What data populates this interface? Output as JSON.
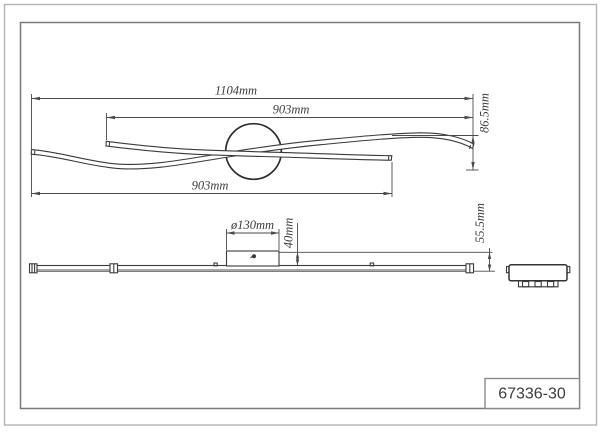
{
  "title_block": {
    "model": "67336-30"
  },
  "plan_view": {
    "label": "top view of wave ceiling light",
    "dim_overall_width": "1104mm",
    "dim_upper_span": "903mm",
    "dim_lower_span": "903mm",
    "dim_height": "86.5mm"
  },
  "elevation_view": {
    "label": "front elevation of light bar with canopy",
    "dim_canopy_diameter": "ø130mm",
    "dim_canopy_height": "40mm",
    "dim_total_height": "55.5mm"
  },
  "end_view": {
    "label": "side / end view of fixture"
  },
  "colors": {
    "object_line": "#3a3a3a",
    "dimension_line": "#4a4a4a",
    "outer_border": "#b3b3b3",
    "inner_border": "#7a7a7a",
    "text": "#3c3c3c",
    "background": "#ffffff"
  }
}
